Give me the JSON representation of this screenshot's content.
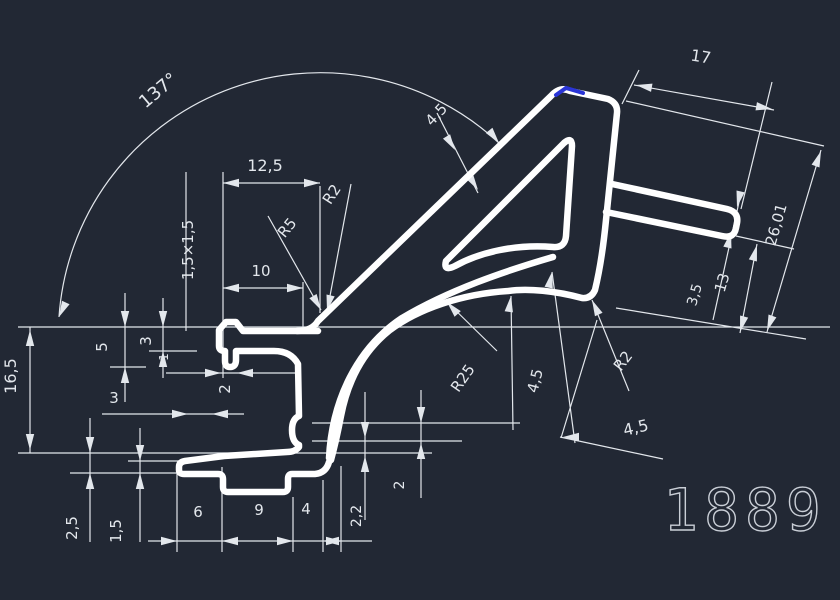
{
  "drawing": {
    "part_number": "1889",
    "colors": {
      "background": "#222834",
      "profile_line": "#ffffff",
      "dimension_line": "#e3e7ec",
      "highlight": "#2a35d6",
      "part_number_color": "#c9ced6"
    },
    "dimension_labels": [
      {
        "name": "angle-137",
        "text": "137°",
        "x": 162,
        "y": 95,
        "rot": -40,
        "size": 18
      },
      {
        "name": "dim-12-5",
        "text": "12,5",
        "x": 265,
        "y": 171,
        "rot": 0,
        "size": 16
      },
      {
        "name": "radius-r2-upper",
        "text": "R2",
        "x": 336,
        "y": 197,
        "rot": -57,
        "size": 15
      },
      {
        "name": "radius-r5",
        "text": "R5",
        "x": 291,
        "y": 231,
        "rot": -50,
        "size": 15
      },
      {
        "name": "dim-1-5x1-5",
        "text": "1,5×1,5",
        "x": 193,
        "y": 250,
        "rot": -90,
        "size": 15
      },
      {
        "name": "dim-10",
        "text": "10",
        "x": 261,
        "y": 276,
        "rot": 0,
        "size": 15
      },
      {
        "name": "dim-4-5-arm",
        "text": "4,5",
        "x": 440,
        "y": 118,
        "rot": -47,
        "size": 15
      },
      {
        "name": "dim-17",
        "text": "17",
        "x": 700,
        "y": 62,
        "rot": 9,
        "size": 16
      },
      {
        "name": "dim-26-01",
        "text": "26,01",
        "x": 781,
        "y": 226,
        "rot": -74,
        "size": 15
      },
      {
        "name": "dim-13",
        "text": "13",
        "x": 727,
        "y": 284,
        "rot": -74,
        "size": 15
      },
      {
        "name": "dim-3-5",
        "text": "3,5",
        "x": 699,
        "y": 296,
        "rot": -74,
        "size": 14
      },
      {
        "name": "radius-r2-lower",
        "text": "R2",
        "x": 627,
        "y": 364,
        "rot": -52,
        "size": 15
      },
      {
        "name": "dim-4-5-flange",
        "text": "4,5",
        "x": 540,
        "y": 382,
        "rot": -76,
        "size": 15
      },
      {
        "name": "radius-r25",
        "text": "R25",
        "x": 467,
        "y": 381,
        "rot": -55,
        "size": 15
      },
      {
        "name": "dim-4-5-bottom",
        "text": "4,5",
        "x": 637,
        "y": 433,
        "rot": -13,
        "size": 16
      },
      {
        "name": "dim-16-5",
        "text": "16,5",
        "x": 16,
        "y": 376,
        "rot": -90,
        "size": 16
      },
      {
        "name": "dim-5",
        "text": "5",
        "x": 107,
        "y": 347,
        "rot": -90,
        "size": 15
      },
      {
        "name": "dim-3-upper",
        "text": "3",
        "x": 151,
        "y": 341,
        "rot": -90,
        "size": 15
      },
      {
        "name": "dim-1",
        "text": "1",
        "x": 168,
        "y": 357,
        "rot": -90,
        "size": 12
      },
      {
        "name": "dim-2-groove",
        "text": "2",
        "x": 230,
        "y": 389,
        "rot": -90,
        "size": 15
      },
      {
        "name": "dim-3-lower",
        "text": "3",
        "x": 114,
        "y": 403,
        "rot": 0,
        "size": 15
      },
      {
        "name": "dim-2-5",
        "text": "2,5",
        "x": 77,
        "y": 528,
        "rot": -90,
        "size": 15
      },
      {
        "name": "dim-1-5",
        "text": "1,5",
        "x": 121,
        "y": 531,
        "rot": -90,
        "size": 15
      },
      {
        "name": "dim-6",
        "text": "6",
        "x": 198,
        "y": 517,
        "rot": 0,
        "size": 15
      },
      {
        "name": "dim-9",
        "text": "9",
        "x": 259,
        "y": 515,
        "rot": 0,
        "size": 15
      },
      {
        "name": "dim-4",
        "text": "4",
        "x": 306,
        "y": 514,
        "rot": 0,
        "size": 15
      },
      {
        "name": "dim-2-2",
        "text": "2,2",
        "x": 361,
        "y": 516,
        "rot": -90,
        "size": 14
      },
      {
        "name": "dim-2-notch",
        "text": "2",
        "x": 404,
        "y": 485,
        "rot": -90,
        "size": 14
      }
    ]
  }
}
